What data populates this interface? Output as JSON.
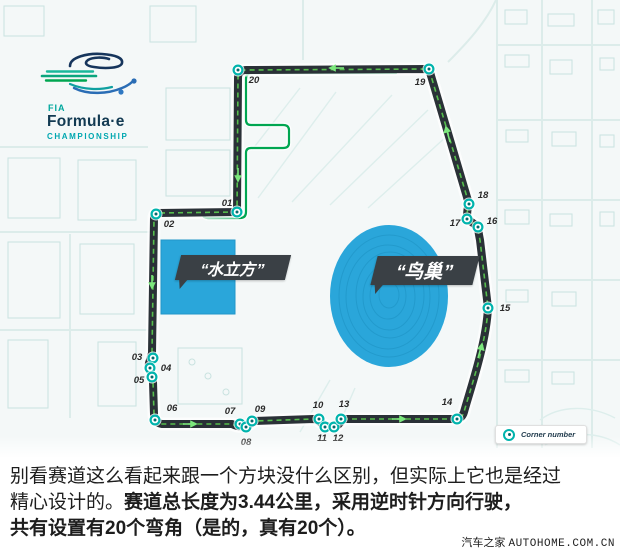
{
  "logo": {
    "fia": "FIA",
    "name": "Formula·e",
    "championship": "CHAMPIONSHIP"
  },
  "banners": {
    "water_cube": "“水立方”",
    "birds_nest": "“鸟巢”"
  },
  "legend": {
    "corner_number": "Corner number"
  },
  "track": {
    "length_note": "3.44公里",
    "direction": "逆时针",
    "corner_count": 20
  },
  "corners": [
    {
      "n": "01",
      "x": 237,
      "y": 212,
      "lx": 227,
      "ly": 206
    },
    {
      "n": "02",
      "x": 156,
      "y": 214,
      "lx": 169,
      "ly": 227
    },
    {
      "n": "03",
      "x": 153,
      "y": 358,
      "lx": 137,
      "ly": 360
    },
    {
      "n": "04",
      "x": 150,
      "y": 368,
      "lx": 166,
      "ly": 371
    },
    {
      "n": "05",
      "x": 152,
      "y": 377,
      "lx": 139,
      "ly": 383
    },
    {
      "n": "06",
      "x": 155,
      "y": 420,
      "lx": 172,
      "ly": 411
    },
    {
      "n": "07",
      "x": 240,
      "y": 424,
      "lx": 230,
      "ly": 414
    },
    {
      "n": "08",
      "x": 246,
      "y": 427,
      "lx": 246,
      "ly": 445
    },
    {
      "n": "09",
      "x": 252,
      "y": 421,
      "lx": 260,
      "ly": 412
    },
    {
      "n": "10",
      "x": 319,
      "y": 419,
      "lx": 318,
      "ly": 408
    },
    {
      "n": "11",
      "x": 325,
      "y": 427,
      "lx": 322,
      "ly": 441
    },
    {
      "n": "12",
      "x": 334,
      "y": 427,
      "lx": 338,
      "ly": 441
    },
    {
      "n": "13",
      "x": 341,
      "y": 419,
      "lx": 344,
      "ly": 407
    },
    {
      "n": "14",
      "x": 457,
      "y": 419,
      "lx": 447,
      "ly": 405
    },
    {
      "n": "15",
      "x": 488,
      "y": 308,
      "lx": 505,
      "ly": 311
    },
    {
      "n": "16",
      "x": 478,
      "y": 227,
      "lx": 492,
      "ly": 224
    },
    {
      "n": "17",
      "x": 467,
      "y": 219,
      "lx": 455,
      "ly": 226
    },
    {
      "n": "18",
      "x": 469,
      "y": 204,
      "lx": 483,
      "ly": 198
    },
    {
      "n": "19",
      "x": 429,
      "y": 69,
      "lx": 420,
      "ly": 85
    },
    {
      "n": "20",
      "x": 238,
      "y": 70,
      "lx": 254,
      "ly": 83
    }
  ],
  "caption": {
    "line1": "别看赛道这么看起来跟一个方块没什么区别，但实际上它也是经过",
    "line2_regular": "精心设计的。",
    "line2_bold": "赛道总长度为3.44公里，采用逆时针方向行驶，",
    "line3_bold": "共有设置有20个弯角（是的，真有20个）。"
  },
  "watermark": {
    "site_cn": "汽车之家",
    "site_en": "AUTOHOME.COM.CN"
  },
  "colors": {
    "road": "#2a3137",
    "road_dash": "#56bd4d",
    "arrow": "#7ce87d",
    "pit_lane": "#00a651",
    "marker_ring": "#00b4ad",
    "marker_dot": "#056a6d",
    "landmark_blue": "#2aa6da",
    "banner_dark": "#3a4045",
    "logo_teal": "#00a79d",
    "logo_navy": "#16355c",
    "logo_blue": "#2a6db5",
    "map_stroke": "#c9e2e0",
    "map_bg": "#f4f8f8"
  }
}
